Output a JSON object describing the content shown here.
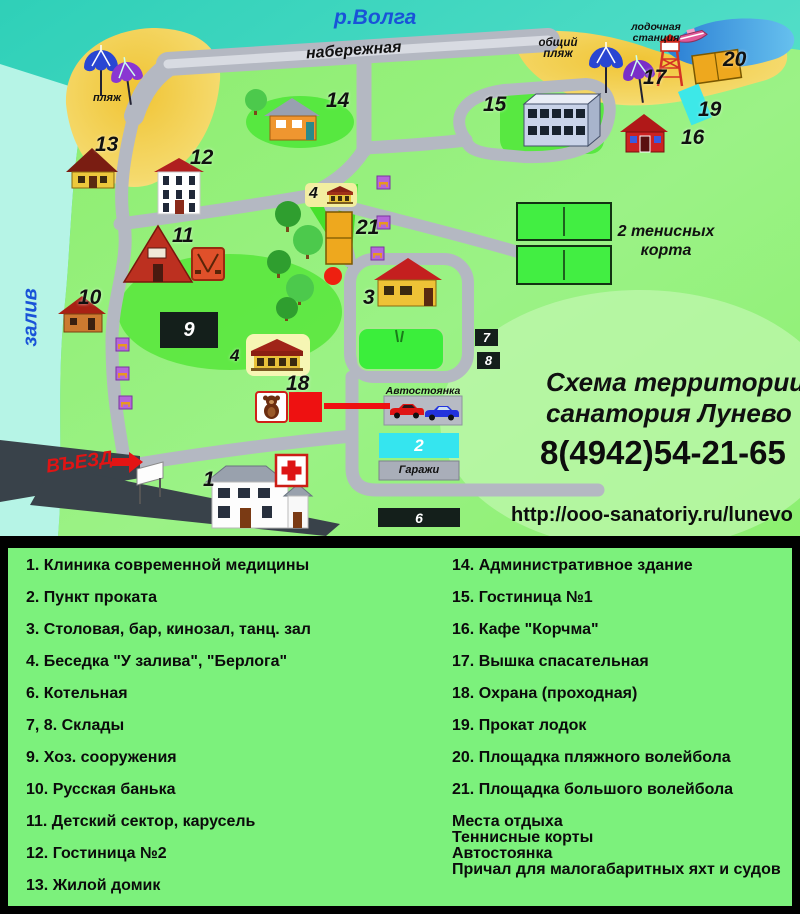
{
  "map": {
    "labels": {
      "river": "р.Волга",
      "embankment": "набережная",
      "beach": "пляж",
      "public_beach_line1": "общий",
      "public_beach_line2": "пляж",
      "boat_station_line1": "лодочная",
      "boat_station_line2": "станция",
      "bay": "залив",
      "tennis_line1": "2 тенисных",
      "tennis_line2": "корта",
      "parking": "Автостоянка",
      "garages": "Гаражи",
      "entrance": "ВЪЕЗД"
    },
    "markers": {
      "m1": "1",
      "m2": "2",
      "m3": "3",
      "m4a": "4",
      "m4b": "4",
      "m6": "6",
      "m7": "7",
      "m8": "8",
      "m9": "9",
      "m10": "10",
      "m11": "11",
      "m12": "12",
      "m13": "13",
      "m14": "14",
      "m15": "15",
      "m16": "16",
      "m17": "17",
      "m18": "18",
      "m19": "19",
      "m20": "20",
      "m21": "21"
    }
  },
  "info": {
    "title_line1": "Схема территории",
    "title_line2": "санатория Лунево",
    "phone": "8(4942)54-21-65",
    "url": "http://ooo-sanatoriy.ru/lunevo"
  },
  "legend": {
    "left": [
      "1. Клиника современной медицины",
      "2. Пункт проката",
      "3. Столовая, бар, кинозал, танц. зал",
      "4. Беседка  \"У залива\", \"Берлога\"",
      "6. Котельная",
      "7, 8. Склады",
      "9. Хоз. сооружения",
      "10. Русская банька",
      "11. Детский сектор, карусель",
      "12. Гостиница №2",
      "13. Жилой домик"
    ],
    "right": [
      "14. Административное здание",
      "15. Гостиница №1",
      "16. Кафе \"Корчма\"",
      "17. Вышка спасательная",
      "18. Охрана (проходная)",
      "19. Прокат лодок",
      "20. Площадка пляжного волейбола",
      "21. Площадка большого волейбола"
    ],
    "extra": [
      "Места отдыха",
      "Теннисные корты",
      "Автостоянка",
      "Причал для малогабаритных яхт и судов"
    ]
  },
  "colors": {
    "sea": "#3ed3bd",
    "land_green": "#8cef75",
    "legend_green": "#7cf17c",
    "sand": "#f2cf4e",
    "road_gray": "#b4b8c2",
    "accent_red": "#ee1010",
    "river_text_blue": "#1953d8"
  }
}
